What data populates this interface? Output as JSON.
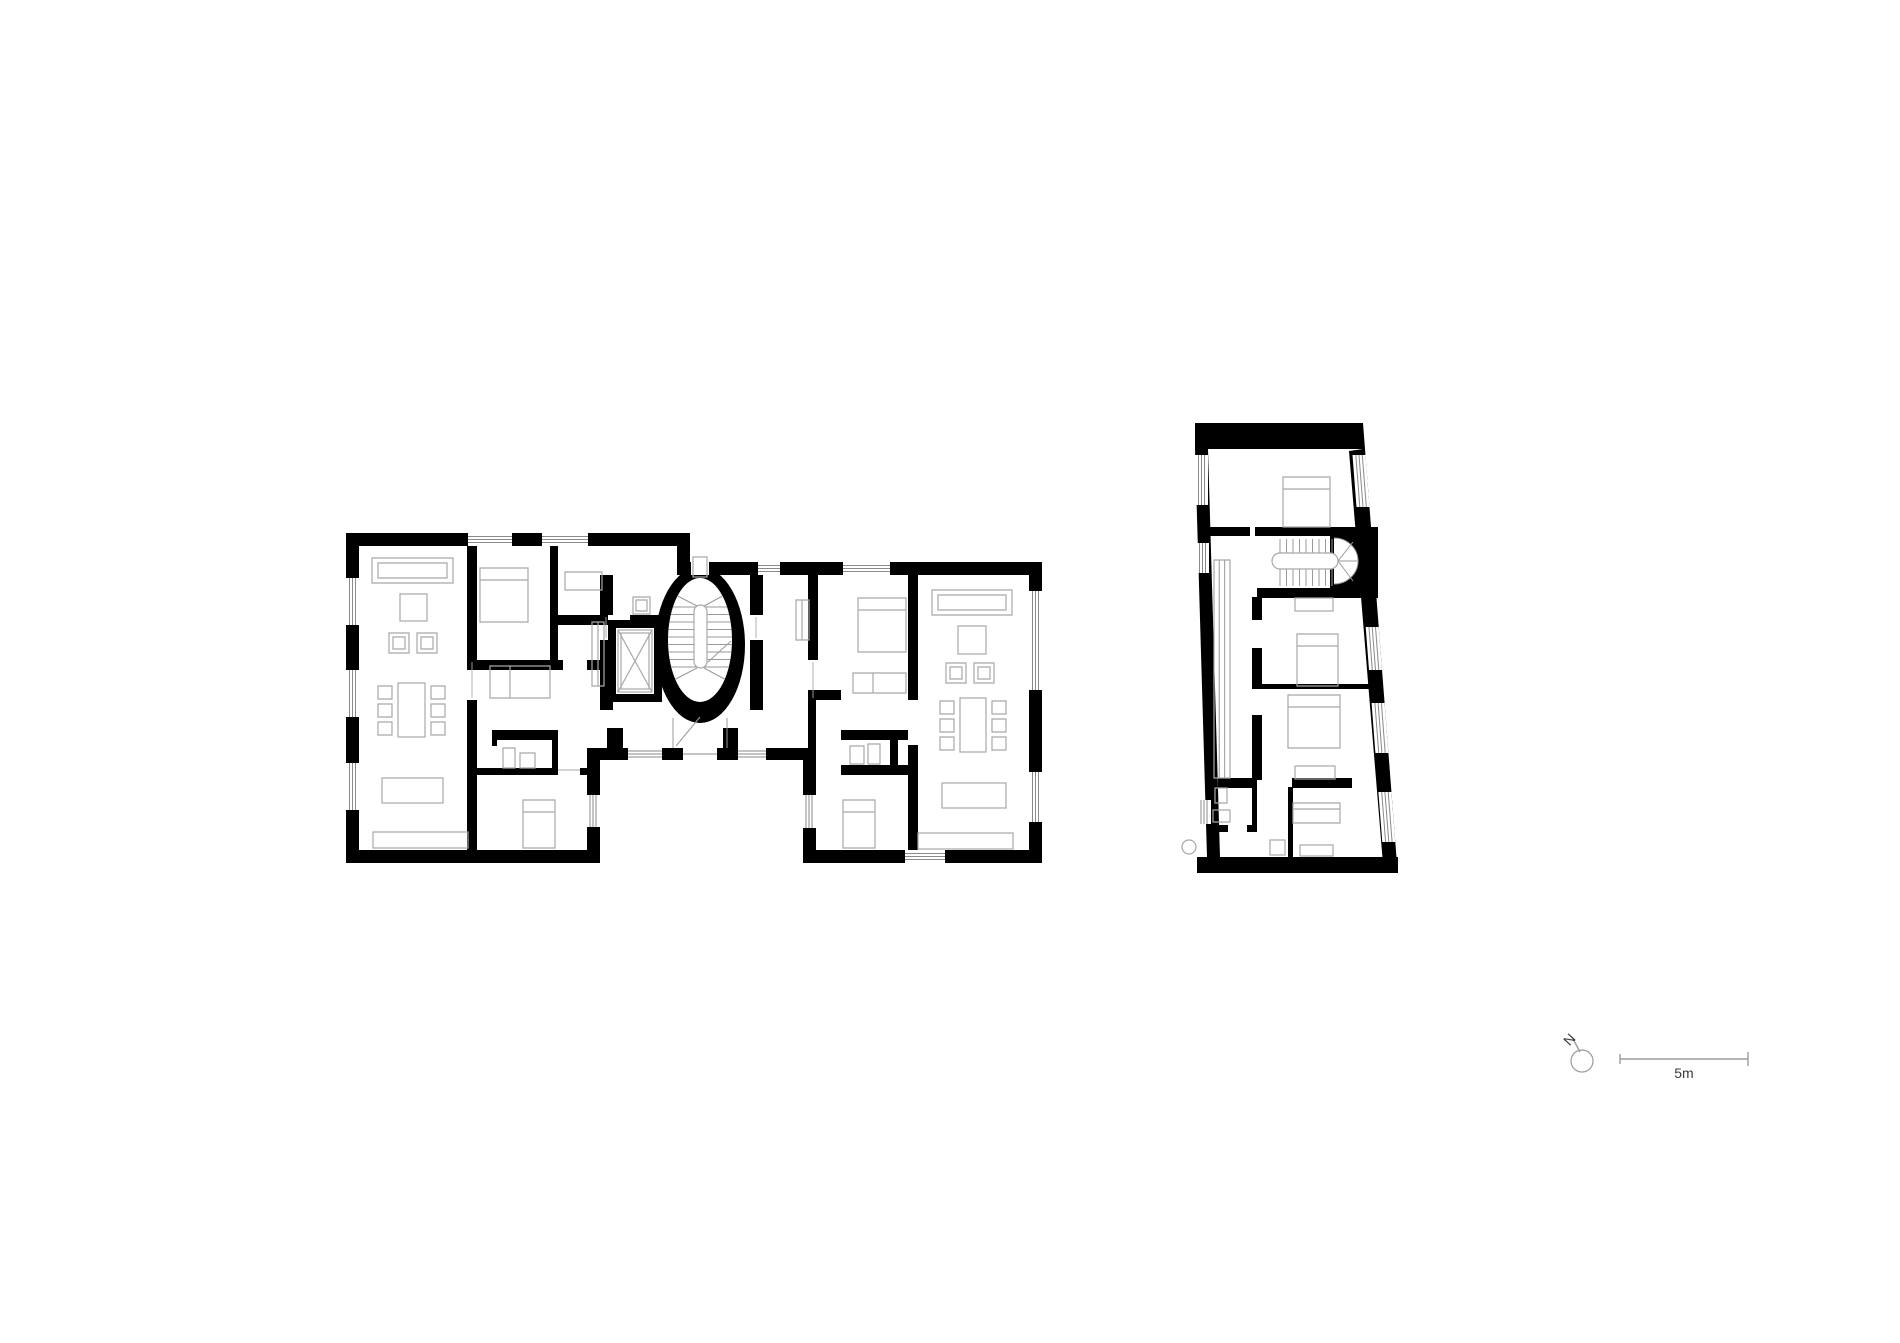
{
  "annotations": {
    "north_label": "N",
    "scale_label": "5m"
  },
  "colors": {
    "background": "#ffffff",
    "wall": "#000000",
    "furniture": "#a8a8a8",
    "glazing": "#8a8a8a",
    "stairline": "#9a9a9a",
    "annotation": "#3a3a3a",
    "scalebar": "#9c9c9c"
  }
}
